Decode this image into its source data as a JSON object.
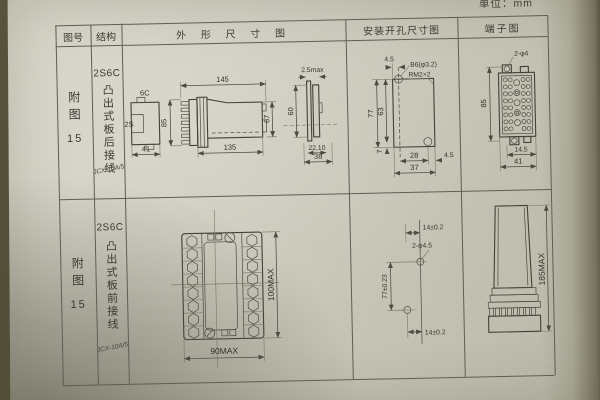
{
  "unit_label": "单位：mm",
  "headers": {
    "fig_no": "图号",
    "structure": "结构",
    "outline": "外 形 尺 寸 图",
    "mounting": "安装开孔尺寸图",
    "terminal": "端子图"
  },
  "rows": [
    {
      "fig_label": "附图",
      "fig_number": "15",
      "model": "2S6C",
      "wiring": "凸出式板后接线",
      "relay_type": "JCX-10A/5",
      "outline": {
        "bracket_code": "6C",
        "bracket_side": "2S",
        "bracket_width": "41",
        "overall_height": "85",
        "flange_width": "145",
        "body_width": "135",
        "body_height": "67",
        "panel_thickness": "2.5max",
        "cutout_height": "60",
        "edge_depth": "22,10",
        "edge_width": "38"
      },
      "mounting": {
        "edge_offset": "4.5",
        "hole_note": "B6(φ3.2)",
        "thread_note": "RM2×2",
        "overall_height": "77",
        "hole_pitch_v": "63",
        "bottom_offset": "7",
        "hole_pitch_h": "28",
        "overall_width": "37",
        "side_offset": "4.5"
      },
      "terminal": {
        "hole_note": "2-φ4",
        "height": "85",
        "pitch": "14.5",
        "width": "41"
      }
    },
    {
      "fig_label": "附图",
      "fig_number": "15",
      "model": "2S6C",
      "wiring": "凸出式板前接线",
      "relay_type": "JCX-10A/5",
      "outline": {
        "width": "90MAX",
        "height": "100MAX"
      },
      "mounting": {
        "top_offset": "14±0.2",
        "hole_note": "2-φ4.5",
        "hole_pitch_v": "77±0.23",
        "bottom_offset": "14±0.2"
      },
      "terminal": {
        "height": "185MAX"
      }
    }
  ]
}
